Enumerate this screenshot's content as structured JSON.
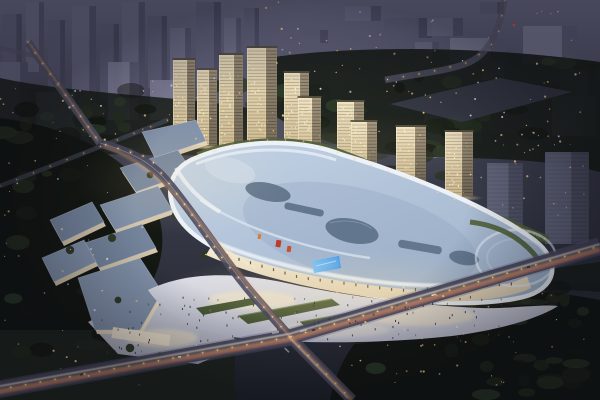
{
  "meta": {
    "alt_text": "Aerial dusk rendering of a mixed-use development: an illuminated shopping mall with a flowing blue-white roof and skylights, a low-rise retail street, a diagonal row of lit residential towers, plazas with people, city roads with warm light trails, dark woodland and a hazy purple skyline."
  },
  "colors": {
    "bg_top": "#5e5e78",
    "bg_mid": "#3a3d4b",
    "bg_bottom": "#23262e",
    "haze": "#9a9ab8",
    "far_a": "#666681",
    "far_b": "#757591",
    "far_c": "#8a8aa4",
    "woods": "#1a1f18",
    "woods_deep": "#141812",
    "tower_face_hi": "#f0e4c4",
    "tower_face_lo": "#c9b68e",
    "tower_side_hi": "#a3957c",
    "tower_side_lo": "#6d6353",
    "gray_face": "#61647a",
    "gray_side": "#4b4e60",
    "roof_hi": "#c3d3e6",
    "roof_lo": "#9cb0c8",
    "roof_rim": "#edf2f8",
    "skylight": "#5d7289",
    "terrace": "#51603a",
    "terrace_hi": "#7b8f4e",
    "strip_roof_a": "#8292a9",
    "strip_roof_b": "#75859c",
    "strip_wall": "#ead9ba",
    "plaza_hi": "#dcdee8",
    "plaza_lo": "#b7bac9",
    "plaza_warm": "#f3e4c3",
    "road": "#4b4b60",
    "road_lt": "#6a6a80",
    "trail_warm": "#ffae6a",
    "trail_white": "#fff3dc",
    "trail_red": "#ff6f5e",
    "lamp": "#ffdca3",
    "dot_warm": "#ffd08a",
    "dot_cool": "#dfe6ff",
    "led_a": "#2f86e0",
    "led_b": "#7cc0f5",
    "accent_red": "#bf3a2a",
    "glow": "#ffe3a8",
    "green_wedge": "#415230",
    "green_wedge_hi": "#6d8148",
    "facade_a": "#f7edd5",
    "facade_b": "#d9cbb0"
  },
  "scene": {
    "far_blocks": [
      [
        2,
        14,
        20,
        86,
        0
      ],
      [
        26,
        2,
        18,
        70,
        1
      ],
      [
        48,
        20,
        17,
        84,
        0
      ],
      [
        72,
        6,
        24,
        98,
        1
      ],
      [
        100,
        24,
        19,
        76,
        0
      ],
      [
        122,
        2,
        23,
        94,
        1
      ],
      [
        148,
        16,
        19,
        72,
        0
      ],
      [
        170,
        28,
        21,
        66,
        1
      ],
      [
        196,
        2,
        25,
        86,
        0
      ],
      [
        224,
        18,
        17,
        62,
        1
      ],
      [
        244,
        8,
        15,
        52,
        0
      ],
      [
        36,
        92,
        54,
        44,
        2
      ],
      [
        108,
        62,
        30,
        58,
        2
      ],
      [
        0,
        62,
        28,
        66,
        1
      ],
      [
        150,
        80,
        34,
        40,
        2
      ],
      [
        300,
        30,
        28,
        13,
        0
      ],
      [
        345,
        6,
        36,
        15,
        1
      ],
      [
        384,
        18,
        48,
        20,
        0
      ],
      [
        427,
        18,
        36,
        18,
        1
      ],
      [
        450,
        38,
        56,
        24,
        2
      ],
      [
        523,
        26,
        54,
        38,
        2
      ],
      [
        560,
        64,
        38,
        34,
        0
      ],
      [
        480,
        2,
        24,
        12,
        0
      ],
      [
        415,
        42,
        24,
        14,
        1
      ],
      [
        482,
        60,
        30,
        20,
        1
      ],
      [
        552,
        96,
        44,
        40,
        2
      ],
      [
        424,
        102,
        30,
        56,
        1
      ],
      [
        458,
        98,
        24,
        46,
        0
      ]
    ],
    "lit_towers": [
      [
        173,
        60,
        22,
        82
      ],
      [
        197,
        70,
        20,
        75
      ],
      [
        219,
        55,
        24,
        93
      ],
      [
        247,
        48,
        30,
        104
      ],
      [
        284,
        73,
        25,
        85
      ],
      [
        298,
        98,
        23,
        67
      ],
      [
        337,
        102,
        27,
        70
      ],
      [
        351,
        122,
        26,
        56
      ],
      [
        396,
        127,
        30,
        58
      ],
      [
        445,
        132,
        28,
        64
      ]
    ],
    "gray_towers": [
      [
        487,
        163,
        36,
        70
      ],
      [
        545,
        152,
        44,
        92
      ]
    ],
    "tree_fields": [
      {
        "x": 0,
        "y": 118,
        "w": 150,
        "h": 235,
        "n": 26
      },
      {
        "x": 340,
        "y": 296,
        "w": 255,
        "h": 100,
        "n": 30
      },
      {
        "x": 255,
        "y": 60,
        "w": 340,
        "h": 92,
        "n": 34
      },
      {
        "x": 0,
        "y": 80,
        "w": 255,
        "h": 62,
        "n": 20
      },
      {
        "x": 360,
        "y": 266,
        "w": 200,
        "h": 38,
        "n": 12
      },
      {
        "x": 198,
        "y": 138,
        "w": 330,
        "h": 52,
        "n": 20
      }
    ],
    "light_fields": [
      {
        "x": 0,
        "y": 78,
        "w": 255,
        "h": 64,
        "n": 38
      },
      {
        "x": 262,
        "y": 2,
        "w": 336,
        "h": 140,
        "n": 55
      },
      {
        "x": 0,
        "y": 150,
        "w": 145,
        "h": 195,
        "n": 26
      },
      {
        "x": 335,
        "y": 292,
        "w": 262,
        "h": 102,
        "n": 40
      },
      {
        "x": 430,
        "y": 60,
        "w": 165,
        "h": 95,
        "n": 22
      },
      {
        "x": 285,
        "y": 58,
        "w": 140,
        "h": 40,
        "n": 10
      },
      {
        "x": 5,
        "y": 332,
        "w": 200,
        "h": 62,
        "n": 10
      },
      {
        "x": 470,
        "y": 140,
        "w": 128,
        "h": 68,
        "n": 14
      }
    ],
    "lamp_lines": [
      {
        "pts": [
          [
            28,
            42
          ],
          [
            38,
            57
          ],
          [
            100,
            143
          ],
          [
            150,
            158
          ],
          [
            185,
            205
          ],
          [
            225,
            262
          ],
          [
            262,
            305
          ],
          [
            290,
            337
          ]
        ],
        "sp": 13,
        "r": 0.9
      },
      {
        "pts": [
          [
            -4,
            390
          ],
          [
            290,
            337
          ],
          [
            600,
            246
          ]
        ],
        "sp": 15,
        "r": 1
      },
      {
        "pts": [
          [
            290,
            337
          ],
          [
            352,
            400
          ]
        ],
        "sp": 13,
        "r": 0.9
      },
      {
        "pts": [
          [
            505,
            0
          ],
          [
            497,
            40
          ],
          [
            470,
            62
          ],
          [
            430,
            72
          ],
          [
            385,
            80
          ]
        ],
        "sp": 16,
        "r": 0.7
      },
      {
        "pts": [
          [
            0,
            186
          ],
          [
            168,
            120
          ]
        ],
        "sp": 18,
        "r": 0.6
      },
      {
        "pts": [
          [
            198,
            156
          ],
          [
            248,
            140
          ],
          [
            300,
            140
          ],
          [
            342,
            154
          ],
          [
            400,
            176
          ],
          [
            460,
            202
          ],
          [
            520,
            228
          ],
          [
            548,
            240
          ]
        ],
        "sp": 18,
        "r": 0.6
      },
      {
        "pts": [
          [
            498,
            286
          ],
          [
            556,
            296
          ]
        ],
        "sp": 9,
        "r": 0.55
      }
    ],
    "people_fields": [
      {
        "x": 175,
        "y": 296,
        "w": 330,
        "h": 44,
        "n": 78
      },
      {
        "x": 100,
        "y": 300,
        "w": 120,
        "h": 52,
        "n": 26
      }
    ],
    "facade_ticks": {
      "pts": [
        [
          216,
          252
        ],
        [
          300,
          277
        ],
        [
          400,
          290
        ],
        [
          520,
          283
        ]
      ],
      "sp": 12
    },
    "car_fractions": [
      0.14,
      0.3,
      0.52,
      0.72,
      0.88
    ]
  }
}
